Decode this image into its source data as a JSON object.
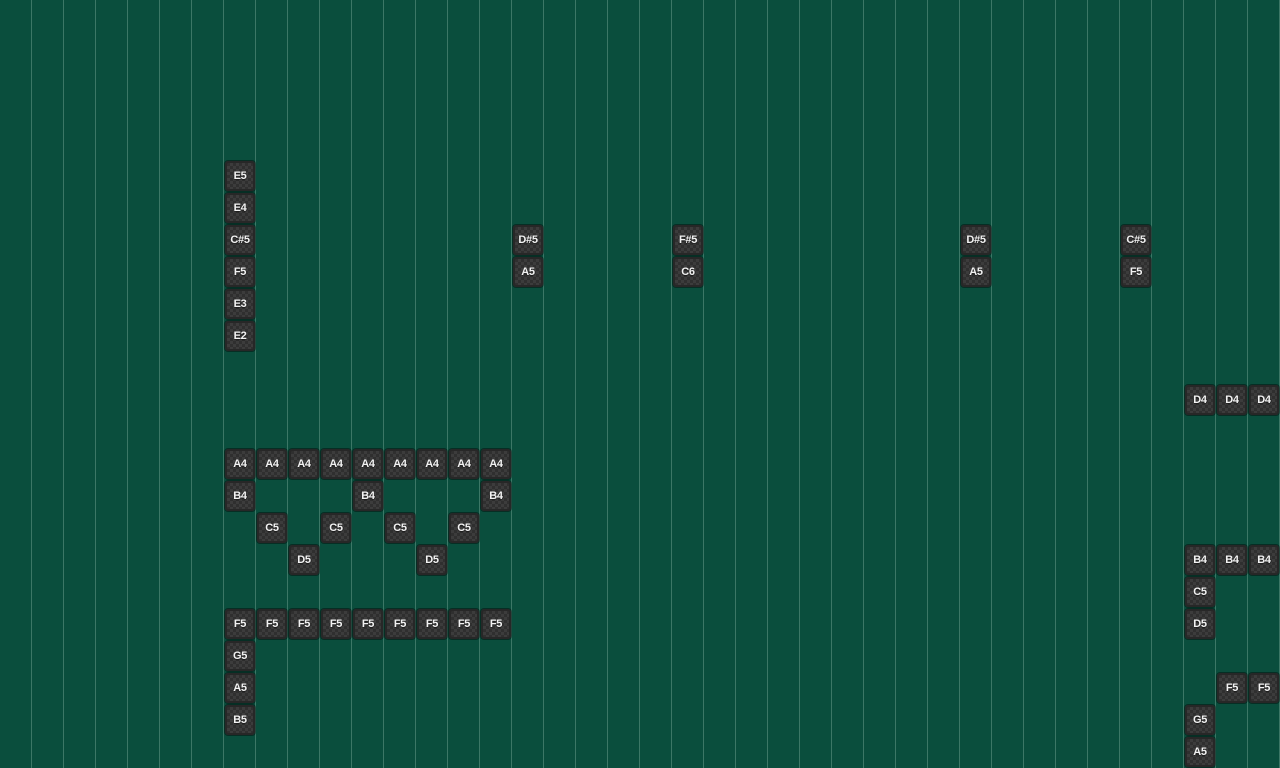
{
  "app": {
    "name": "music sequencer note grid",
    "view": "piano-roll scroll area"
  },
  "grid": {
    "cell_size": 32,
    "columns": 40,
    "rows": 24,
    "background_color": "#0a4e3d",
    "gridline_color": "rgba(190,225,210,0.28)",
    "gridline_orientation": "vertical",
    "tile_checker_light": "#3c3c3c",
    "tile_checker_dark": "#2f2f2f",
    "tile_border_color": "#272727",
    "tile_text_color": "#f2f2f2",
    "tile_size": 30
  },
  "tiles": [
    {
      "note": "E5",
      "col": 7,
      "row": 5
    },
    {
      "note": "E4",
      "col": 7,
      "row": 6
    },
    {
      "note": "C#5",
      "col": 7,
      "row": 7
    },
    {
      "note": "D#5",
      "col": 16,
      "row": 7
    },
    {
      "note": "F#5",
      "col": 21,
      "row": 7
    },
    {
      "note": "D#5",
      "col": 30,
      "row": 7
    },
    {
      "note": "C#5",
      "col": 35,
      "row": 7
    },
    {
      "note": "F5",
      "col": 7,
      "row": 8
    },
    {
      "note": "A5",
      "col": 16,
      "row": 8
    },
    {
      "note": "C6",
      "col": 21,
      "row": 8
    },
    {
      "note": "A5",
      "col": 30,
      "row": 8
    },
    {
      "note": "F5",
      "col": 35,
      "row": 8
    },
    {
      "note": "E3",
      "col": 7,
      "row": 9
    },
    {
      "note": "E2",
      "col": 7,
      "row": 10
    },
    {
      "note": "D4",
      "col": 37,
      "row": 12
    },
    {
      "note": "D4",
      "col": 38,
      "row": 12
    },
    {
      "note": "D4",
      "col": 39,
      "row": 12
    },
    {
      "note": "A4",
      "col": 7,
      "row": 14
    },
    {
      "note": "A4",
      "col": 8,
      "row": 14
    },
    {
      "note": "A4",
      "col": 9,
      "row": 14
    },
    {
      "note": "A4",
      "col": 10,
      "row": 14
    },
    {
      "note": "A4",
      "col": 11,
      "row": 14
    },
    {
      "note": "A4",
      "col": 12,
      "row": 14
    },
    {
      "note": "A4",
      "col": 13,
      "row": 14
    },
    {
      "note": "A4",
      "col": 14,
      "row": 14
    },
    {
      "note": "A4",
      "col": 15,
      "row": 14
    },
    {
      "note": "B4",
      "col": 7,
      "row": 15
    },
    {
      "note": "B4",
      "col": 11,
      "row": 15
    },
    {
      "note": "B4",
      "col": 15,
      "row": 15
    },
    {
      "note": "C5",
      "col": 8,
      "row": 16
    },
    {
      "note": "C5",
      "col": 10,
      "row": 16
    },
    {
      "note": "C5",
      "col": 12,
      "row": 16
    },
    {
      "note": "C5",
      "col": 14,
      "row": 16
    },
    {
      "note": "D5",
      "col": 9,
      "row": 17
    },
    {
      "note": "D5",
      "col": 13,
      "row": 17
    },
    {
      "note": "B4",
      "col": 37,
      "row": 17
    },
    {
      "note": "B4",
      "col": 38,
      "row": 17
    },
    {
      "note": "B4",
      "col": 39,
      "row": 17
    },
    {
      "note": "C5",
      "col": 37,
      "row": 18
    },
    {
      "note": "F5",
      "col": 7,
      "row": 19
    },
    {
      "note": "F5",
      "col": 8,
      "row": 19
    },
    {
      "note": "F5",
      "col": 9,
      "row": 19
    },
    {
      "note": "F5",
      "col": 10,
      "row": 19
    },
    {
      "note": "F5",
      "col": 11,
      "row": 19
    },
    {
      "note": "F5",
      "col": 12,
      "row": 19
    },
    {
      "note": "F5",
      "col": 13,
      "row": 19
    },
    {
      "note": "F5",
      "col": 14,
      "row": 19
    },
    {
      "note": "F5",
      "col": 15,
      "row": 19
    },
    {
      "note": "D5",
      "col": 37,
      "row": 19
    },
    {
      "note": "G5",
      "col": 7,
      "row": 20
    },
    {
      "note": "A5",
      "col": 7,
      "row": 21
    },
    {
      "note": "F5",
      "col": 38,
      "row": 21
    },
    {
      "note": "F5",
      "col": 39,
      "row": 21
    },
    {
      "note": "B5",
      "col": 7,
      "row": 22
    },
    {
      "note": "G5",
      "col": 37,
      "row": 22
    },
    {
      "note": "A5",
      "col": 37,
      "row": 23
    }
  ]
}
